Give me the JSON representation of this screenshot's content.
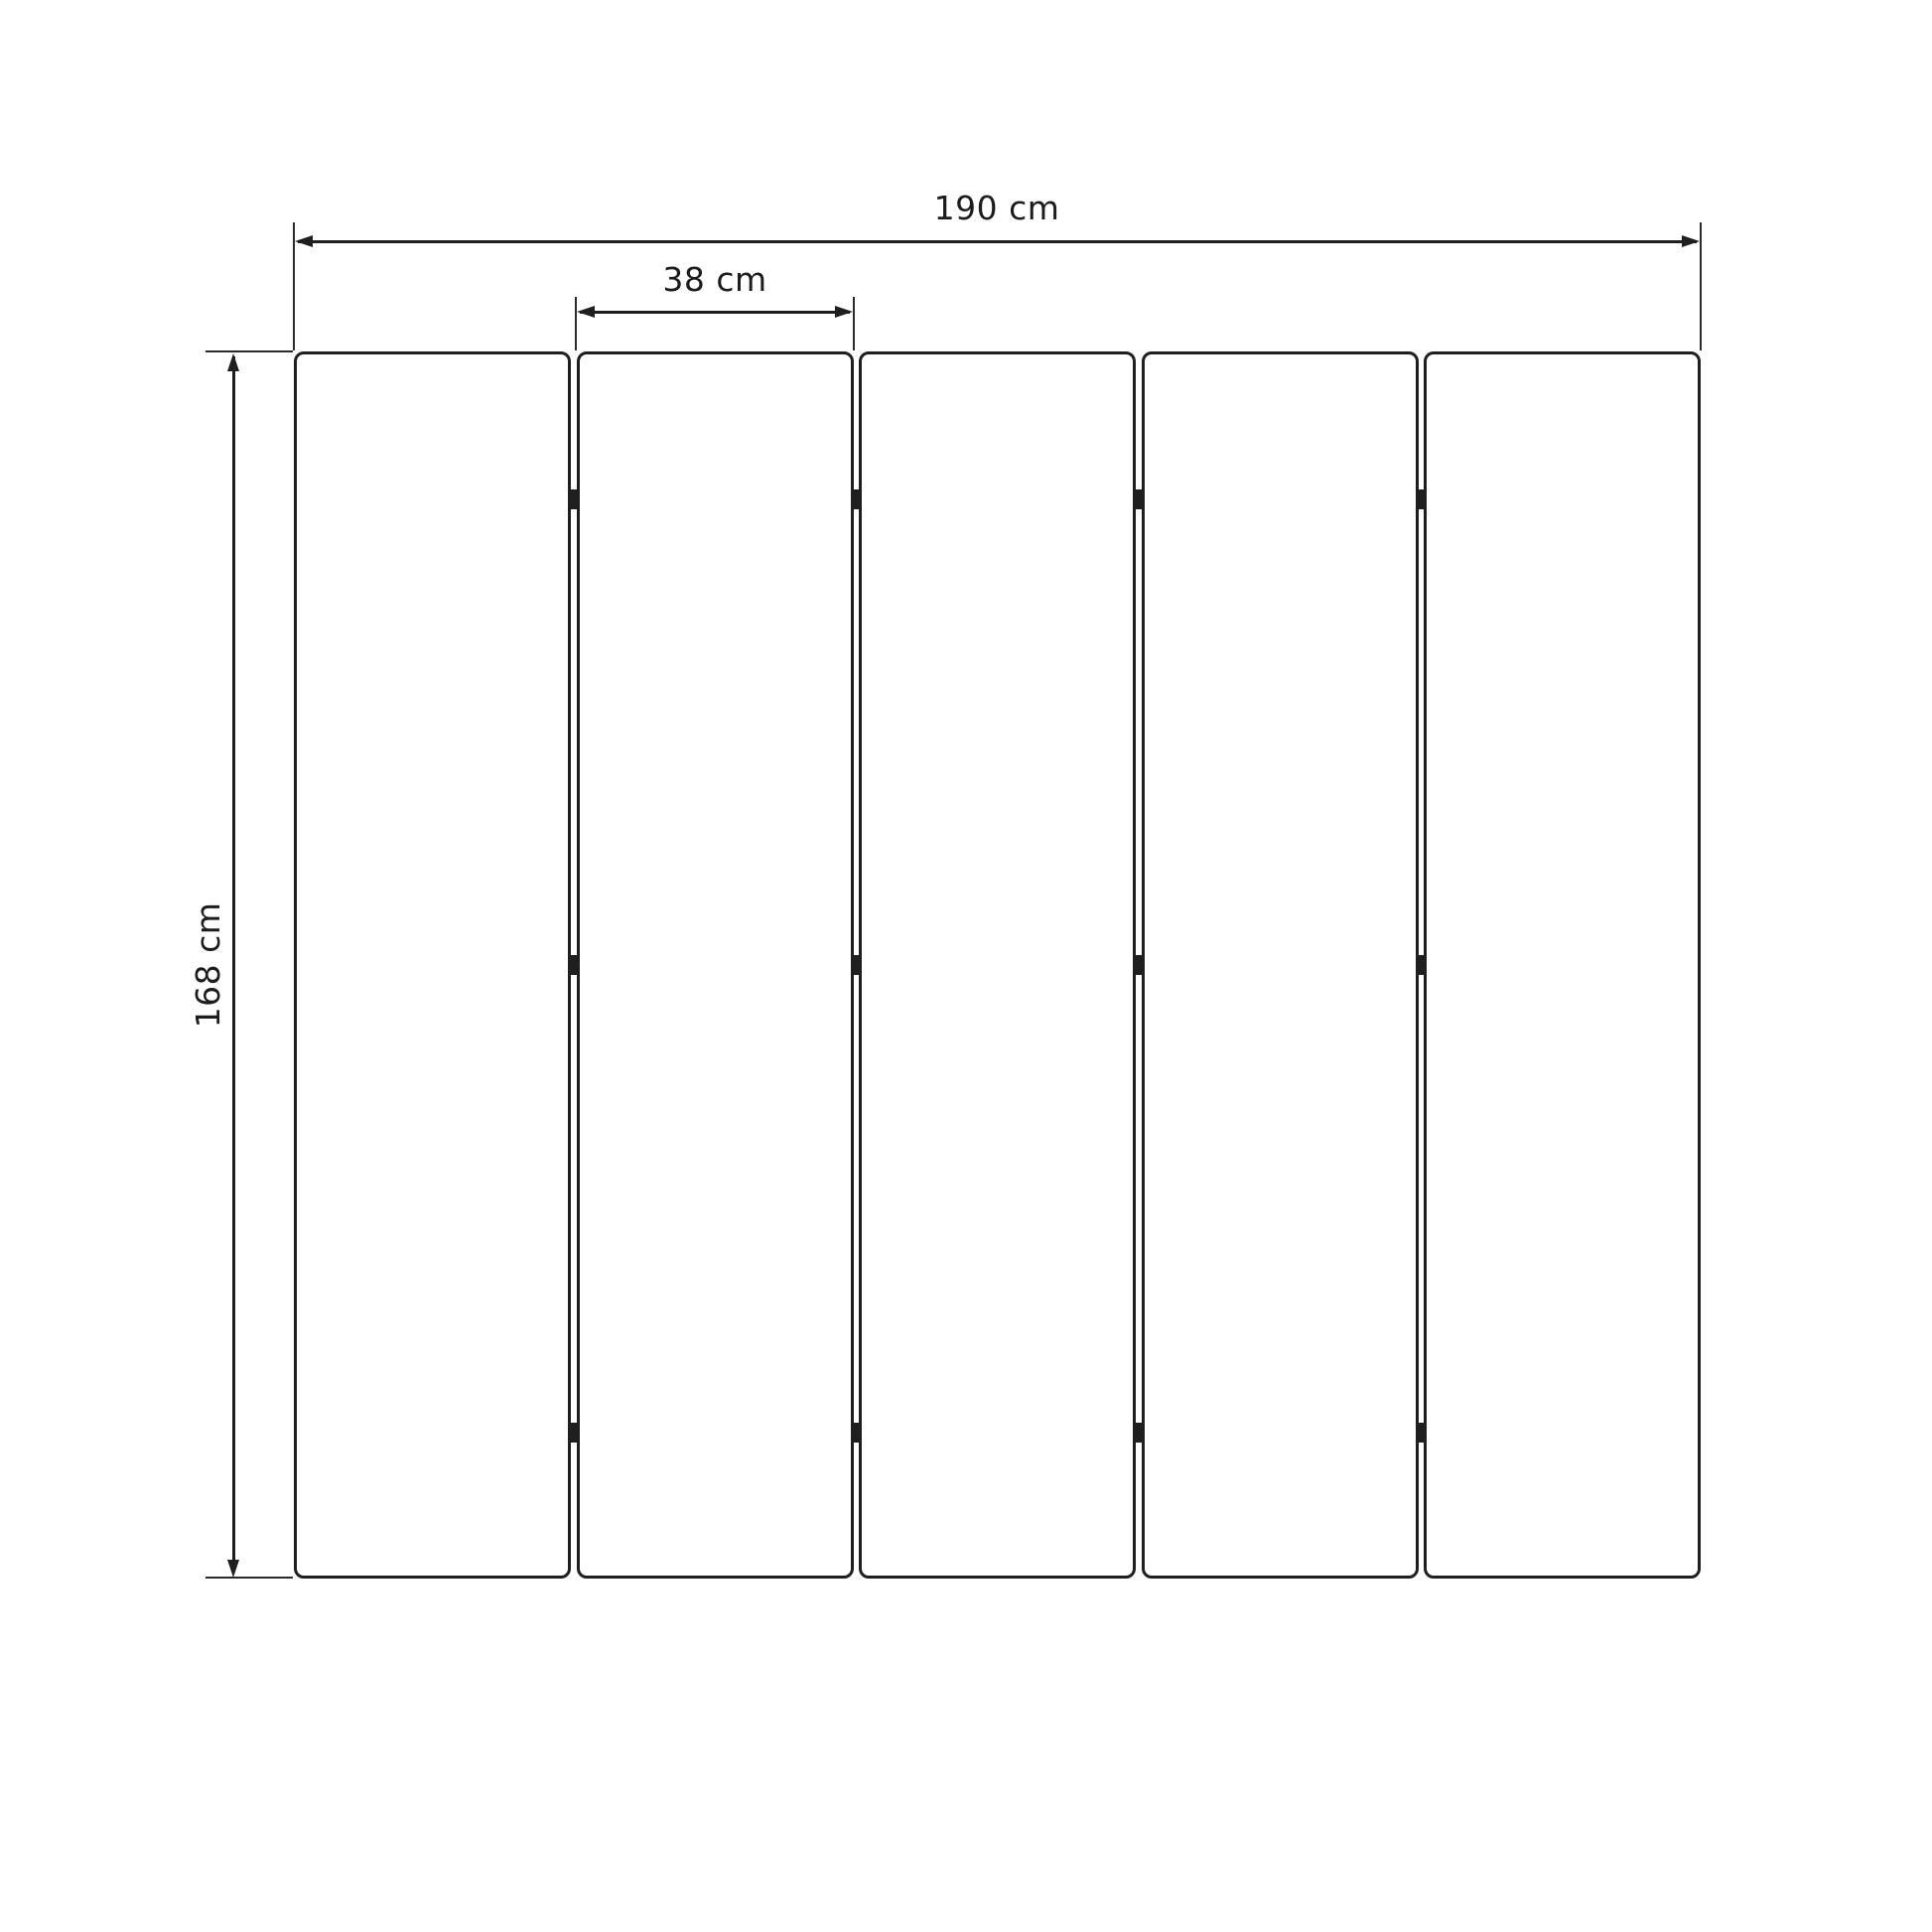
{
  "diagram": {
    "type": "technical-dimension-drawing",
    "subject": "five-panel folding screen room divider, front elevation",
    "unit": "cm",
    "panel_count": 5,
    "hinge_columns": 4,
    "hinge_rows": 3,
    "colors": {
      "line": "#1f1f1f",
      "background": "#ffffff",
      "text": "#1c1c1c"
    },
    "dimensions": {
      "total_width": {
        "value": 190,
        "unit": "cm",
        "label": "190 cm"
      },
      "panel_width": {
        "value": 38,
        "unit": "cm",
        "label": "38 cm"
      },
      "height": {
        "value": 168,
        "unit": "cm",
        "label": "168 cm"
      }
    }
  }
}
